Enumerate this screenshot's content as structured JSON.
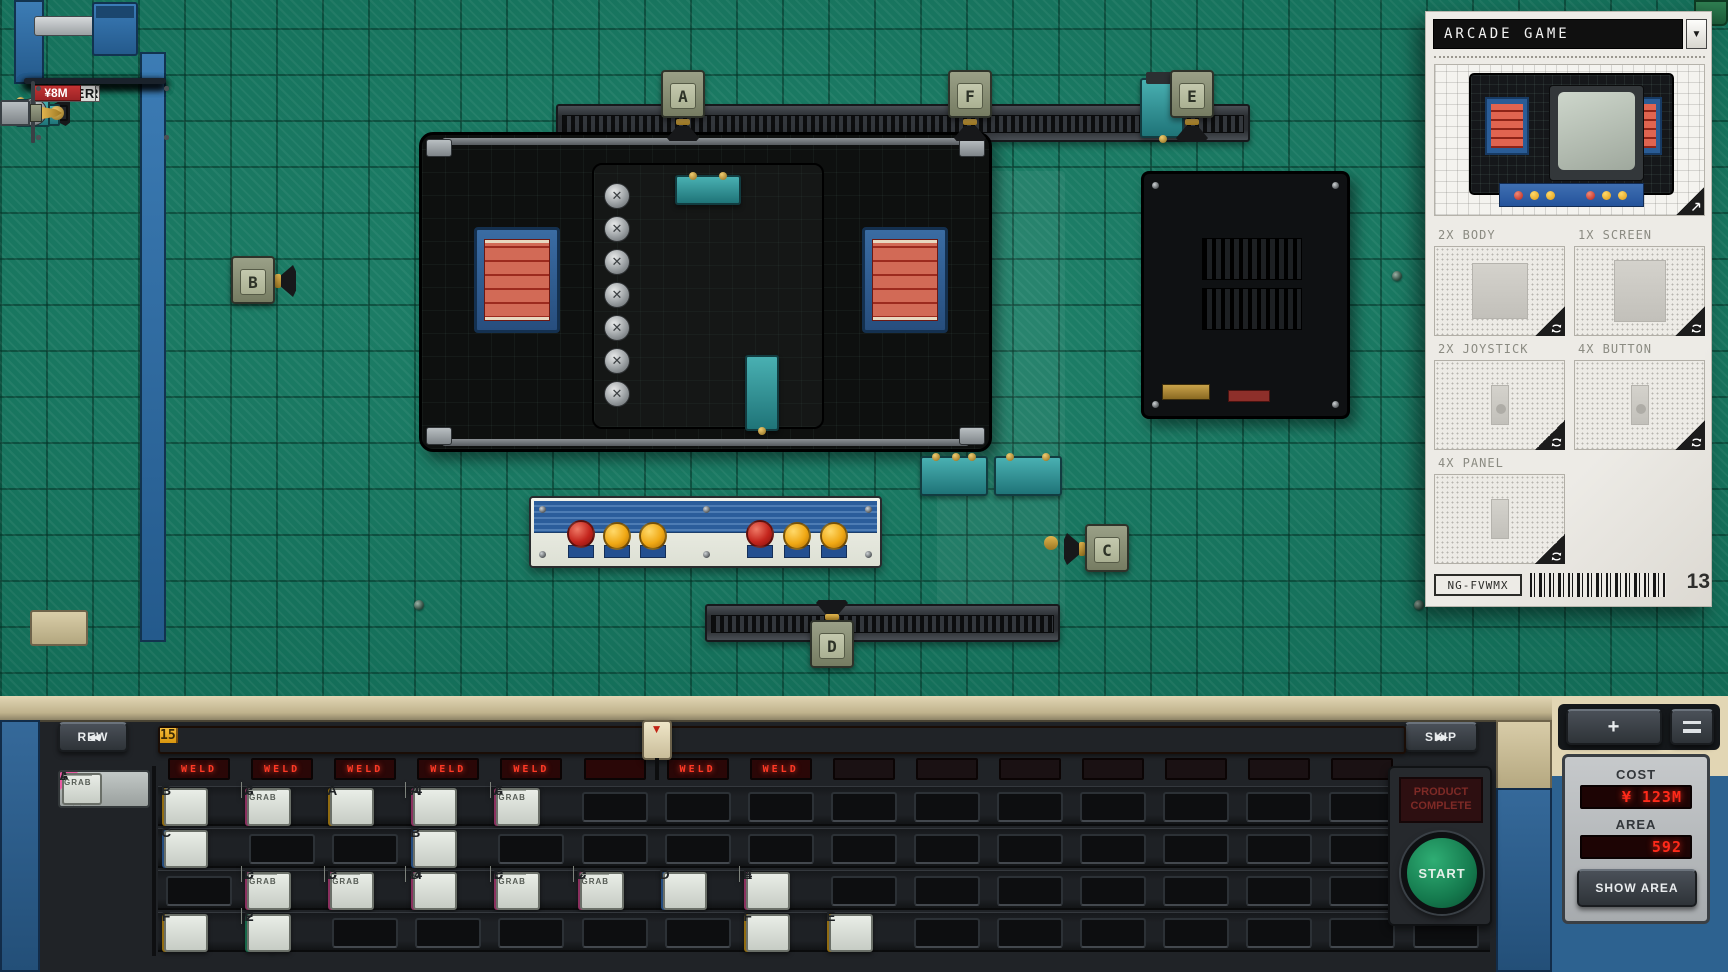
{
  "colors": {
    "chip_yellow": "#f2b51d",
    "chip_pink": "#e8509e",
    "chip_blue": "#3d7ed0",
    "chip_green": "#27b07c",
    "corner_green": "#35c08a",
    "corner_blue": "#4788d8",
    "corner_yellow": "#f2c027",
    "corner_pink": "#ea5aa4",
    "led_red": "#ff3a26",
    "ruler_red": "#b5331f",
    "ruler_yellow": "#e9a91c",
    "price_red": "#b02a2e",
    "start_green": "#1d9563"
  },
  "icons": {
    "rew": "◀◀",
    "skip": "▶▶",
    "dropdown": "▼",
    "playhead": "▼",
    "plus": "+",
    "minus": "−"
  },
  "palette": {
    "items": [
      {
        "name": "ARM",
        "price": "¥8M",
        "art": "arm"
      },
      {
        "name": "TRACK",
        "price": "¥1M+",
        "art": "track"
      },
      {
        "name": "WELDER",
        "price": "¥5M",
        "art": "welder"
      },
      {
        "name": "RIVETER",
        "price": "¥5M",
        "art": "riveter"
      },
      {
        "name": "CUTTER",
        "price": "¥3M",
        "art": "cutter"
      },
      {
        "name": "DRILL",
        "price": "¥8M",
        "art": "drill"
      }
    ]
  },
  "field": {
    "machines": [
      {
        "label": "A"
      },
      {
        "label": "B"
      },
      {
        "label": "C"
      },
      {
        "label": "D"
      },
      {
        "label": "E"
      },
      {
        "label": "F"
      }
    ]
  },
  "blueprint": {
    "title": "ARCADE GAME",
    "parts": [
      {
        "label": "2X BODY",
        "shape": "body"
      },
      {
        "label": "1X SCREEN",
        "shape": "screen"
      },
      {
        "label": "2X JOYSTICK",
        "shape": "joystick"
      },
      {
        "label": "4X BUTTON",
        "shape": "button"
      },
      {
        "label": "4X PANEL",
        "shape": "panel"
      }
    ],
    "code": "NG-FVWMX",
    "count": "13"
  },
  "sequencer": {
    "rew_label": "REW",
    "skip_label": "SKIP",
    "ruler": [
      "1",
      "2",
      "3",
      "4",
      "5",
      "6",
      "7",
      "8",
      "9",
      "10",
      "11",
      "12",
      "13",
      "14",
      "15"
    ],
    "red_segments": 6,
    "playhead_after": 6,
    "leds": [
      "WELD",
      "WELD",
      "WELD",
      "WELD",
      "WELD",
      "",
      "WELD",
      "WELD",
      null,
      null,
      null,
      null,
      null,
      null,
      null
    ],
    "legend": [
      {
        "color": "green",
        "icon": "up",
        "tag": "A|1",
        "sub": null
      },
      {
        "color": "blue",
        "icon": "updown",
        "tag": "A",
        "sub": null
      },
      {
        "color": "yellow",
        "icon": "loop",
        "tag": "A",
        "sub": null
      },
      {
        "color": "pink",
        "icon": "leftright",
        "tag": "A|1",
        "sub": "GRAB"
      }
    ],
    "rows": [
      {
        "cells": [
          {
            "color": "yellow",
            "icon": "loop",
            "tag": "B",
            "sub": null
          },
          {
            "color": "pink",
            "icon": "leftright",
            "tag": "A|3",
            "sub": "GRAB"
          },
          {
            "color": "yellow",
            "icon": "loop",
            "tag": "A",
            "sub": null
          },
          {
            "color": "pink",
            "icon": "leftright-outline",
            "tag": "A|-4",
            "sub": ""
          },
          {
            "color": "pink",
            "icon": "leftright",
            "tag": "A|5",
            "sub": "GRAB"
          },
          null,
          null,
          null,
          null,
          null,
          null,
          null,
          null,
          null,
          null,
          null
        ]
      },
      {
        "cells": [
          {
            "color": "blue",
            "icon": "updown",
            "tag": "C",
            "sub": null
          },
          null,
          null,
          {
            "color": "blue",
            "icon": "updown",
            "tag": "B",
            "sub": null
          },
          null,
          null,
          null,
          null,
          null,
          null,
          null,
          null,
          null,
          null,
          null,
          null
        ]
      },
      {
        "cells": [
          null,
          {
            "color": "pink",
            "icon": "leftright",
            "tag": "D|3",
            "sub": "GRAB"
          },
          {
            "color": "pink",
            "icon": "leftright",
            "tag": "D|3",
            "sub": "GRAB"
          },
          {
            "color": "pink",
            "icon": "leftright-outline",
            "tag": "D|-4",
            "sub": ""
          },
          {
            "color": "pink",
            "icon": "leftright",
            "tag": "D|5",
            "sub": "GRAB"
          },
          {
            "color": "pink",
            "icon": "leftright",
            "tag": "D|2",
            "sub": "GRAB"
          },
          {
            "color": "blue",
            "icon": "updown",
            "tag": "D",
            "sub": null
          },
          {
            "color": "pink",
            "icon": "leftright-outline",
            "tag": "E|4",
            "sub": ""
          },
          null,
          null,
          null,
          null,
          null,
          null,
          null,
          null
        ]
      },
      {
        "cells": [
          {
            "color": "yellow",
            "icon": "loop",
            "tag": "F",
            "sub": null
          },
          {
            "color": "green",
            "icon": "up",
            "tag": "E|2",
            "sub": ""
          },
          null,
          null,
          null,
          null,
          null,
          {
            "color": "yellow",
            "icon": "loop",
            "tag": "F",
            "sub": null
          },
          {
            "color": "yellow",
            "icon": "loop",
            "tag": "E",
            "sub": null
          },
          null,
          null,
          null,
          null,
          null,
          null,
          null
        ]
      }
    ]
  },
  "tower": {
    "cost_label": "COST",
    "cost_value": "¥ 123M",
    "area_label": "AREA",
    "area_value": "592",
    "show_area_label": "SHOW AREA",
    "start_label": "START",
    "complete_label": "PRODUCT COMPLETE"
  }
}
